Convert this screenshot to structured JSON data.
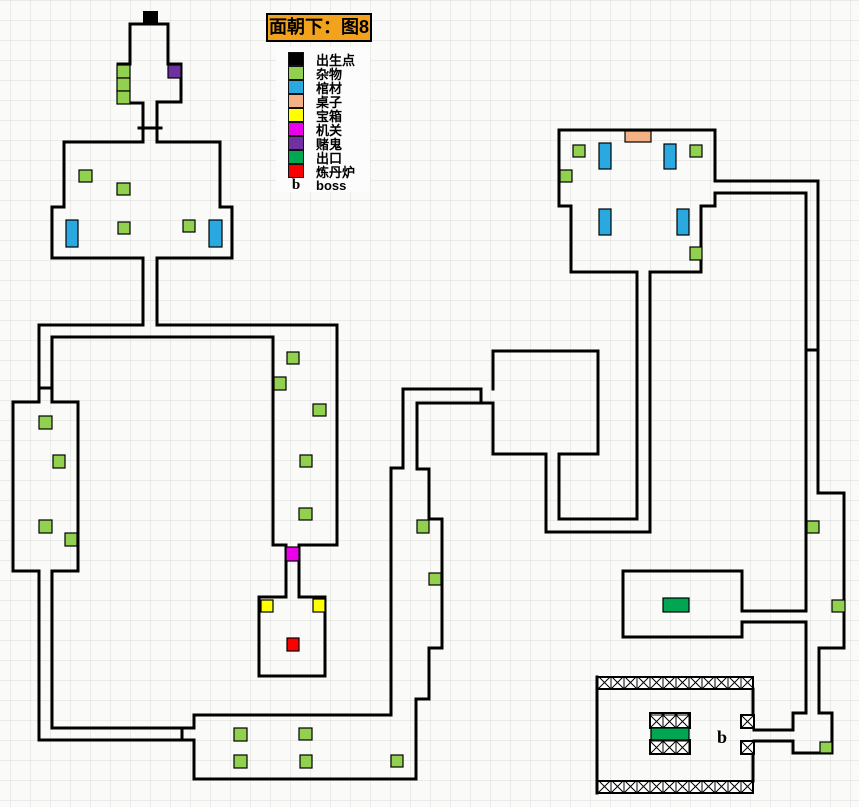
{
  "title": {
    "text": "面朝下：图8",
    "bg": "#F2A31B"
  },
  "legend": {
    "items": [
      {
        "label": "出生点"
      },
      {
        "label": "杂物"
      },
      {
        "label": "棺材"
      },
      {
        "label": "桌子"
      },
      {
        "label": "宝箱"
      },
      {
        "label": "机关"
      },
      {
        "label": "赌鬼"
      },
      {
        "label": "出口"
      },
      {
        "label": "炼丹炉"
      },
      {
        "symbol": "b",
        "label": "boss"
      }
    ]
  },
  "map": {
    "grid": {
      "cell": 20,
      "line_color": "#D9D9D9",
      "bg": "#FAFAF8"
    },
    "wall_color": "#000000",
    "wall_width": 3,
    "palette": {
      "出生点": "#000000",
      "杂物": "#92D050",
      "棺材": "#29A9E0",
      "桌子": "#F4B183",
      "宝箱": "#FFFF00",
      "机关": "#EC00EC",
      "赌鬼": "#7030A0",
      "出口": "#00A651",
      "炼丹炉": "#FB0000"
    },
    "type_names": {
      "出生点": "spawn-point",
      "杂物": "sundries",
      "棺材": "coffin",
      "桌子": "table",
      "宝箱": "treasure-chest",
      "机关": "mechanism",
      "赌鬼": "gambler",
      "出口": "exit",
      "炼丹炉": "alchemy-furnace"
    },
    "walls": [
      "M143,103 L118,103 L118,64 L130,64 L130,24 L168,24 L168,64 L181,64 L181,102 L157,102",
      "M143,103 L143,142",
      "M157,102 L157,142",
      "M139,128 L161,128",
      "M64,142 L143,142",
      "M157,142 L220,142",
      "M64,142 L64,207 L52,207 L52,258",
      "M220,142 L220,207 L232,207 L232,258",
      "M52,258 L143,258",
      "M157,258 L232,258",
      "M143,258 L143,325",
      "M157,258 L157,325",
      "M143,325 L39,325 L39,402",
      "M52,402 L52,337 L273,337 L273,545",
      "M157,325 L337,325 L337,545 L299,545",
      "M273,545 L286,545",
      "M39,388 L52,388",
      "M13,402 L39,402",
      "M52,402 L78,402",
      "M13,402 L13,571",
      "M78,402 L78,571",
      "M13,571 L39,571",
      "M52,571 L78,571",
      "M39,571 L39,740",
      "M52,571 L52,728",
      "M52,728 L194,728 L194,715",
      "M182,728 L182,740",
      "M39,740 L194,740 L194,779",
      "M194,715 L391,715",
      "M194,779 L416,779",
      "M286,545 L286,597",
      "M299,545 L299,597",
      "M259,597 L286,597",
      "M299,597 L325,597",
      "M259,597 L259,676 L325,676 L325,597",
      "M391,715 L391,468 L403,468 L403,389",
      "M417,403 L417,469 L429,469 L429,519 L442,519 L442,648 L429,648 L429,699 L416,699 L416,779",
      "M403,389 L481,389",
      "M481,389 L481,403",
      "M417,403 L493,403",
      "M493,389 L493,351 L598,351 L598,454 L559,454",
      "M493,403 L493,454 L546,454",
      "M546,454 L546,532 L650,532 L650,272",
      "M559,454 L559,519 L637,519 L637,272",
      "M559,130 L715,130",
      "M559,130 L559,206 L571,206 L571,272 L637,272",
      "M650,272 L701,272 L701,206 L715,206 L715,193",
      "M715,130 L715,181",
      "M715,181 L818,181 L818,493 L844,493 L844,648 L819,648 L819,713",
      "M715,193 L806,193 L806,611",
      "M806,622 L806,713",
      "M806,350 L818,350",
      "M742,611 L742,571 L623,571 L623,637 L742,637 L742,622",
      "M742,611 L806,611",
      "M742,622 L806,622",
      "M793,713 L806,713",
      "M819,713 L832,713 L832,753 L793,753 L793,741",
      "M793,730 L793,713",
      "M754,730 L793,730",
      "M754,741 L793,741",
      "M597,677 L597,793",
      "M753,689 L753,715",
      "M753,754 L753,781"
    ],
    "hatched_walls": [
      {
        "x": 597,
        "y": 677,
        "w": 156,
        "h": 12
      },
      {
        "x": 597,
        "y": 781,
        "w": 156,
        "h": 12
      },
      {
        "x": 741,
        "y": 715,
        "w": 13,
        "h": 13
      },
      {
        "x": 741,
        "y": 741,
        "w": 13,
        "h": 13
      },
      {
        "x": 650,
        "y": 713,
        "w": 40,
        "h": 15
      },
      {
        "x": 650,
        "y": 740,
        "w": 40,
        "h": 14
      }
    ],
    "markers": [
      {
        "type": "出生点",
        "x": 143,
        "y": 11,
        "w": 15,
        "h": 13
      },
      {
        "type": "杂物",
        "x": 117,
        "y": 65,
        "w": 13,
        "h": 13
      },
      {
        "type": "杂物",
        "x": 117,
        "y": 78,
        "w": 13,
        "h": 13
      },
      {
        "type": "杂物",
        "x": 117,
        "y": 91,
        "w": 13,
        "h": 13
      },
      {
        "type": "赌鬼",
        "x": 168,
        "y": 65,
        "w": 13,
        "h": 13
      },
      {
        "type": "杂物",
        "x": 79,
        "y": 170,
        "w": 13,
        "h": 12
      },
      {
        "type": "杂物",
        "x": 117,
        "y": 183,
        "w": 13,
        "h": 12
      },
      {
        "type": "棺材",
        "x": 66,
        "y": 220,
        "w": 12,
        "h": 27
      },
      {
        "type": "杂物",
        "x": 118,
        "y": 222,
        "w": 12,
        "h": 12
      },
      {
        "type": "杂物",
        "x": 183,
        "y": 220,
        "w": 12,
        "h": 12
      },
      {
        "type": "棺材",
        "x": 209,
        "y": 220,
        "w": 13,
        "h": 27
      },
      {
        "type": "杂物",
        "x": 287,
        "y": 352,
        "w": 12,
        "h": 12
      },
      {
        "type": "杂物",
        "x": 274,
        "y": 377,
        "w": 12,
        "h": 13
      },
      {
        "type": "杂物",
        "x": 313,
        "y": 404,
        "w": 13,
        "h": 12
      },
      {
        "type": "杂物",
        "x": 300,
        "y": 455,
        "w": 12,
        "h": 12
      },
      {
        "type": "杂物",
        "x": 299,
        "y": 508,
        "w": 13,
        "h": 12
      },
      {
        "type": "机关",
        "x": 286,
        "y": 547,
        "w": 13,
        "h": 14
      },
      {
        "type": "宝箱",
        "x": 261,
        "y": 600,
        "w": 12,
        "h": 12
      },
      {
        "type": "宝箱",
        "x": 313,
        "y": 599,
        "w": 12,
        "h": 13
      },
      {
        "type": "炼丹炉",
        "x": 287,
        "y": 638,
        "w": 12,
        "h": 13
      },
      {
        "type": "杂物",
        "x": 39,
        "y": 416,
        "w": 13,
        "h": 13
      },
      {
        "type": "杂物",
        "x": 53,
        "y": 455,
        "w": 12,
        "h": 13
      },
      {
        "type": "杂物",
        "x": 39,
        "y": 520,
        "w": 13,
        "h": 13
      },
      {
        "type": "杂物",
        "x": 65,
        "y": 533,
        "w": 12,
        "h": 13
      },
      {
        "type": "杂物",
        "x": 417,
        "y": 520,
        "w": 12,
        "h": 13
      },
      {
        "type": "杂物",
        "x": 429,
        "y": 573,
        "w": 12,
        "h": 12
      },
      {
        "type": "杂物",
        "x": 234,
        "y": 728,
        "w": 13,
        "h": 13
      },
      {
        "type": "杂物",
        "x": 299,
        "y": 728,
        "w": 13,
        "h": 12
      },
      {
        "type": "杂物",
        "x": 234,
        "y": 755,
        "w": 13,
        "h": 13
      },
      {
        "type": "杂物",
        "x": 300,
        "y": 755,
        "w": 12,
        "h": 13
      },
      {
        "type": "杂物",
        "x": 391,
        "y": 755,
        "w": 12,
        "h": 12
      },
      {
        "type": "桌子",
        "x": 625,
        "y": 131,
        "w": 26,
        "h": 11
      },
      {
        "type": "杂物",
        "x": 573,
        "y": 145,
        "w": 12,
        "h": 12
      },
      {
        "type": "棺材",
        "x": 599,
        "y": 143,
        "w": 12,
        "h": 26
      },
      {
        "type": "棺材",
        "x": 664,
        "y": 144,
        "w": 12,
        "h": 25
      },
      {
        "type": "杂物",
        "x": 690,
        "y": 145,
        "w": 12,
        "h": 12
      },
      {
        "type": "杂物",
        "x": 560,
        "y": 170,
        "w": 12,
        "h": 12
      },
      {
        "type": "棺材",
        "x": 599,
        "y": 209,
        "w": 12,
        "h": 26
      },
      {
        "type": "棺材",
        "x": 677,
        "y": 209,
        "w": 12,
        "h": 26
      },
      {
        "type": "杂物",
        "x": 690,
        "y": 247,
        "w": 12,
        "h": 13
      },
      {
        "type": "杂物",
        "x": 807,
        "y": 521,
        "w": 12,
        "h": 12
      },
      {
        "type": "杂物",
        "x": 832,
        "y": 600,
        "w": 13,
        "h": 12
      },
      {
        "type": "出口",
        "x": 663,
        "y": 598,
        "w": 26,
        "h": 14
      },
      {
        "type": "杂物",
        "x": 820,
        "y": 742,
        "w": 12,
        "h": 11
      },
      {
        "type": "出口",
        "x": 651,
        "y": 728,
        "w": 38,
        "h": 12
      }
    ],
    "boss_label": {
      "text": "b",
      "x": 717,
      "y": 743
    }
  }
}
